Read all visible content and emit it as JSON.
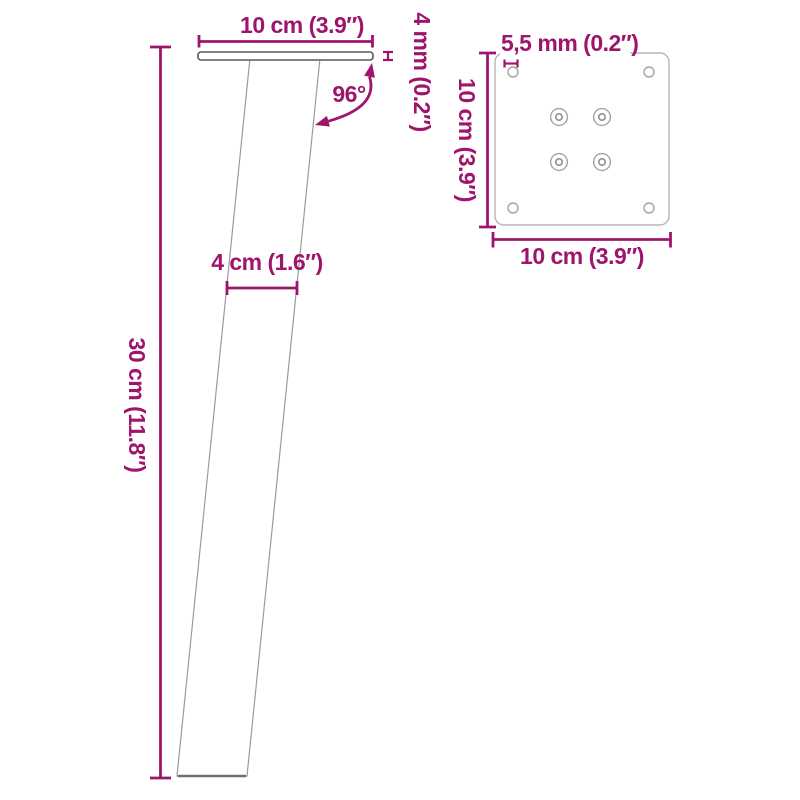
{
  "colors": {
    "accent": "#9E156B",
    "leg_outline": "#9B9B9B",
    "leg_bottom_edge": "#6F6F6F",
    "plate_side_outline": "#585858",
    "plate_top_outline": "#B6B6B6",
    "hole_outline": "#A3A3A3",
    "background": "#FFFFFF"
  },
  "side_view": {
    "top_width_label": "10 cm (3.9″)",
    "plate_thickness_label": "4 mm (0.2″)",
    "angle_label": "96°",
    "leg_width_label": "4 cm (1.6″)",
    "height_label": "30 cm (11.8″)"
  },
  "top_view": {
    "hole_diameter_label": "5,5 mm (0.2″)",
    "height_label": "10 cm (3.9″)",
    "width_label": "10 cm (3.9″)"
  }
}
